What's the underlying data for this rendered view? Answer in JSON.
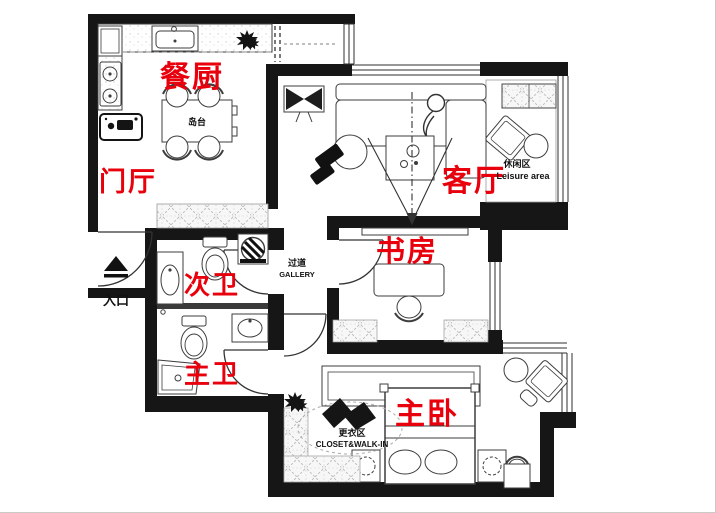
{
  "title": "apartment-floor-plan",
  "colors": {
    "label_red": "#e8000d",
    "wall_black": "#161616",
    "line": "#3d3d3d",
    "hatch": "#bcbcbc"
  },
  "rooms": {
    "dining_kitchen": {
      "label": "餐厨"
    },
    "foyer": {
      "label": "门厅"
    },
    "living": {
      "label": "客厅"
    },
    "study": {
      "label": "书房"
    },
    "second_bath": {
      "label": "次卫"
    },
    "master_bath": {
      "label": "主卫"
    },
    "master_bedroom": {
      "label": "主卧"
    }
  },
  "annotations": {
    "entrance": {
      "label": "入口"
    },
    "leisure": {
      "zh": "休闲区",
      "en": "Leisure area"
    },
    "gallery": {
      "zh": "过道",
      "en": "GALLERY"
    },
    "closet": {
      "zh": "更衣区",
      "en": "CLOSET&WALK-IN"
    },
    "island": {
      "label": "岛台"
    }
  }
}
